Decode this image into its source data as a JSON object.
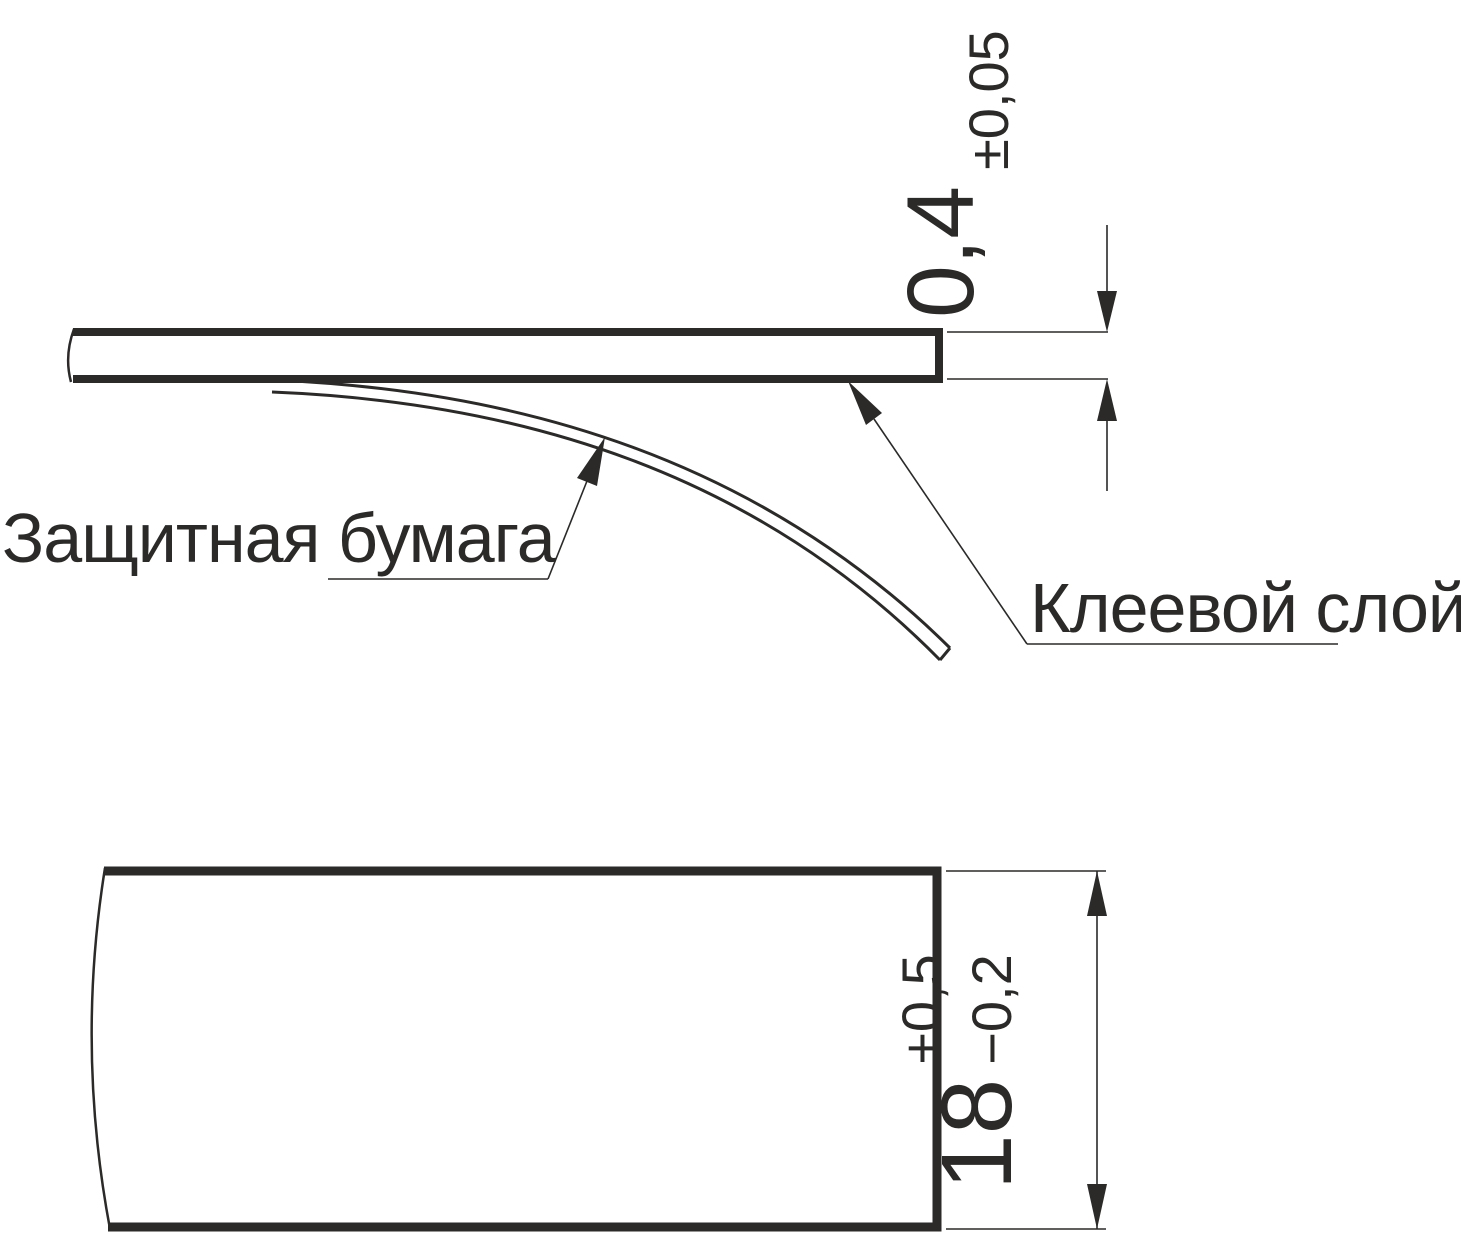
{
  "drawing": {
    "type": "technical-drawing",
    "labels": {
      "protective_paper": "Защитная бумага",
      "adhesive_layer": "Клеевой слой"
    },
    "dimensions": {
      "thickness": {
        "value": "0,4",
        "tolerance": "±0,05"
      },
      "width": {
        "value": "18",
        "tolerance_plus": "+0,5",
        "tolerance_minus": "−0,2"
      }
    },
    "colors": {
      "line": "#2b2a29",
      "background": "#ffffff"
    }
  }
}
